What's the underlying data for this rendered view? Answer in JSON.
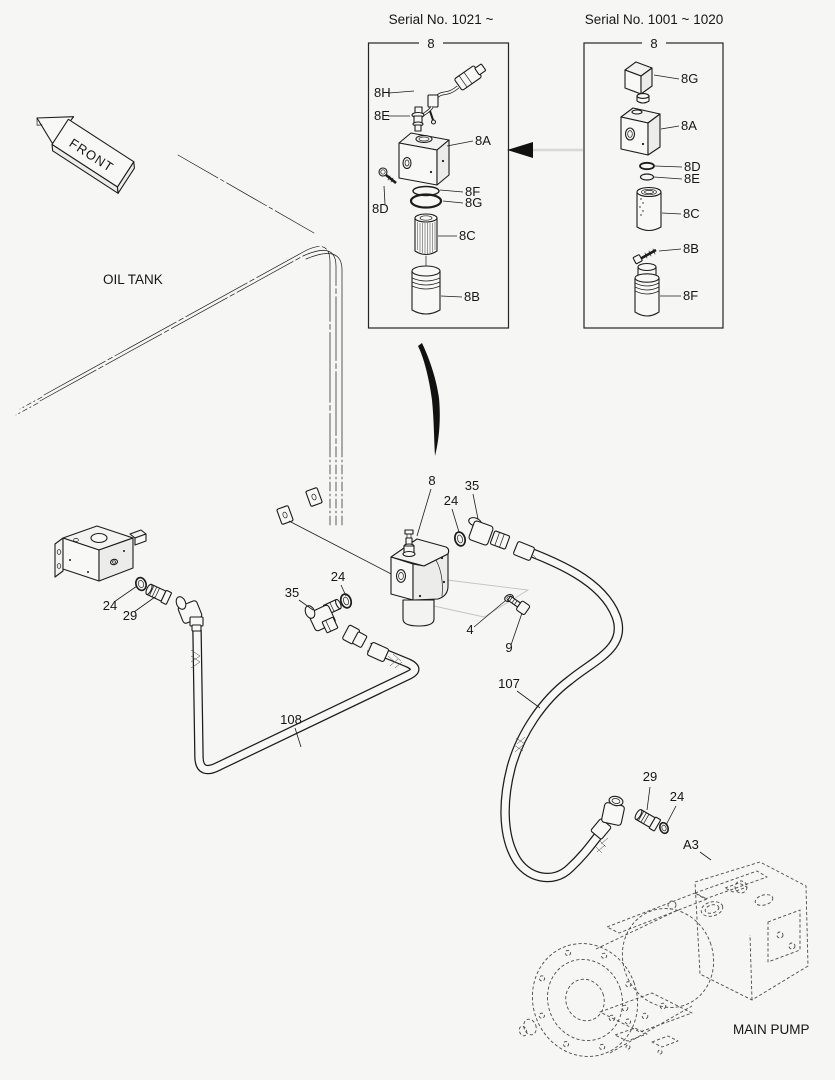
{
  "colors": {
    "background": "#f6f6f4",
    "line": "#1c1c1c",
    "light_guide_line": "#c3c3c3",
    "phantom_dashed_line": "#4a4a4a"
  },
  "annotations": {
    "front": "FRONT",
    "oil_tank": "OIL TANK",
    "main_pump": "MAIN PUMP"
  },
  "left_box": {
    "serial_title": "Serial No. 1021 ~",
    "group_label": "8",
    "parts": {
      "harness": "8H",
      "sensor": "8E",
      "body": "8A",
      "bolt": "8D",
      "oring_f": "8F",
      "oring_g": "8G",
      "element": "8C",
      "case": "8B"
    }
  },
  "right_box": {
    "serial_title": "Serial No. 1001 ~ 1020",
    "group_label": "8",
    "parts": {
      "solenoid": "8G",
      "body": "8A",
      "oring_d": "8D",
      "oring_e": "8E",
      "element": "8C",
      "bolt": "8B",
      "case": "8F"
    }
  },
  "assembly": {
    "valve_group": "8",
    "oring_right": "24",
    "elbow_right": "35",
    "oring_left": "24",
    "elbow_left": "35",
    "plug": "4",
    "bolt": "9"
  },
  "bracket": {
    "oring": "24",
    "fitting": "29"
  },
  "hoses": {
    "left": "108",
    "right": "107"
  },
  "pump_port": {
    "fitting": "29",
    "oring": "24",
    "port": "A3"
  }
}
